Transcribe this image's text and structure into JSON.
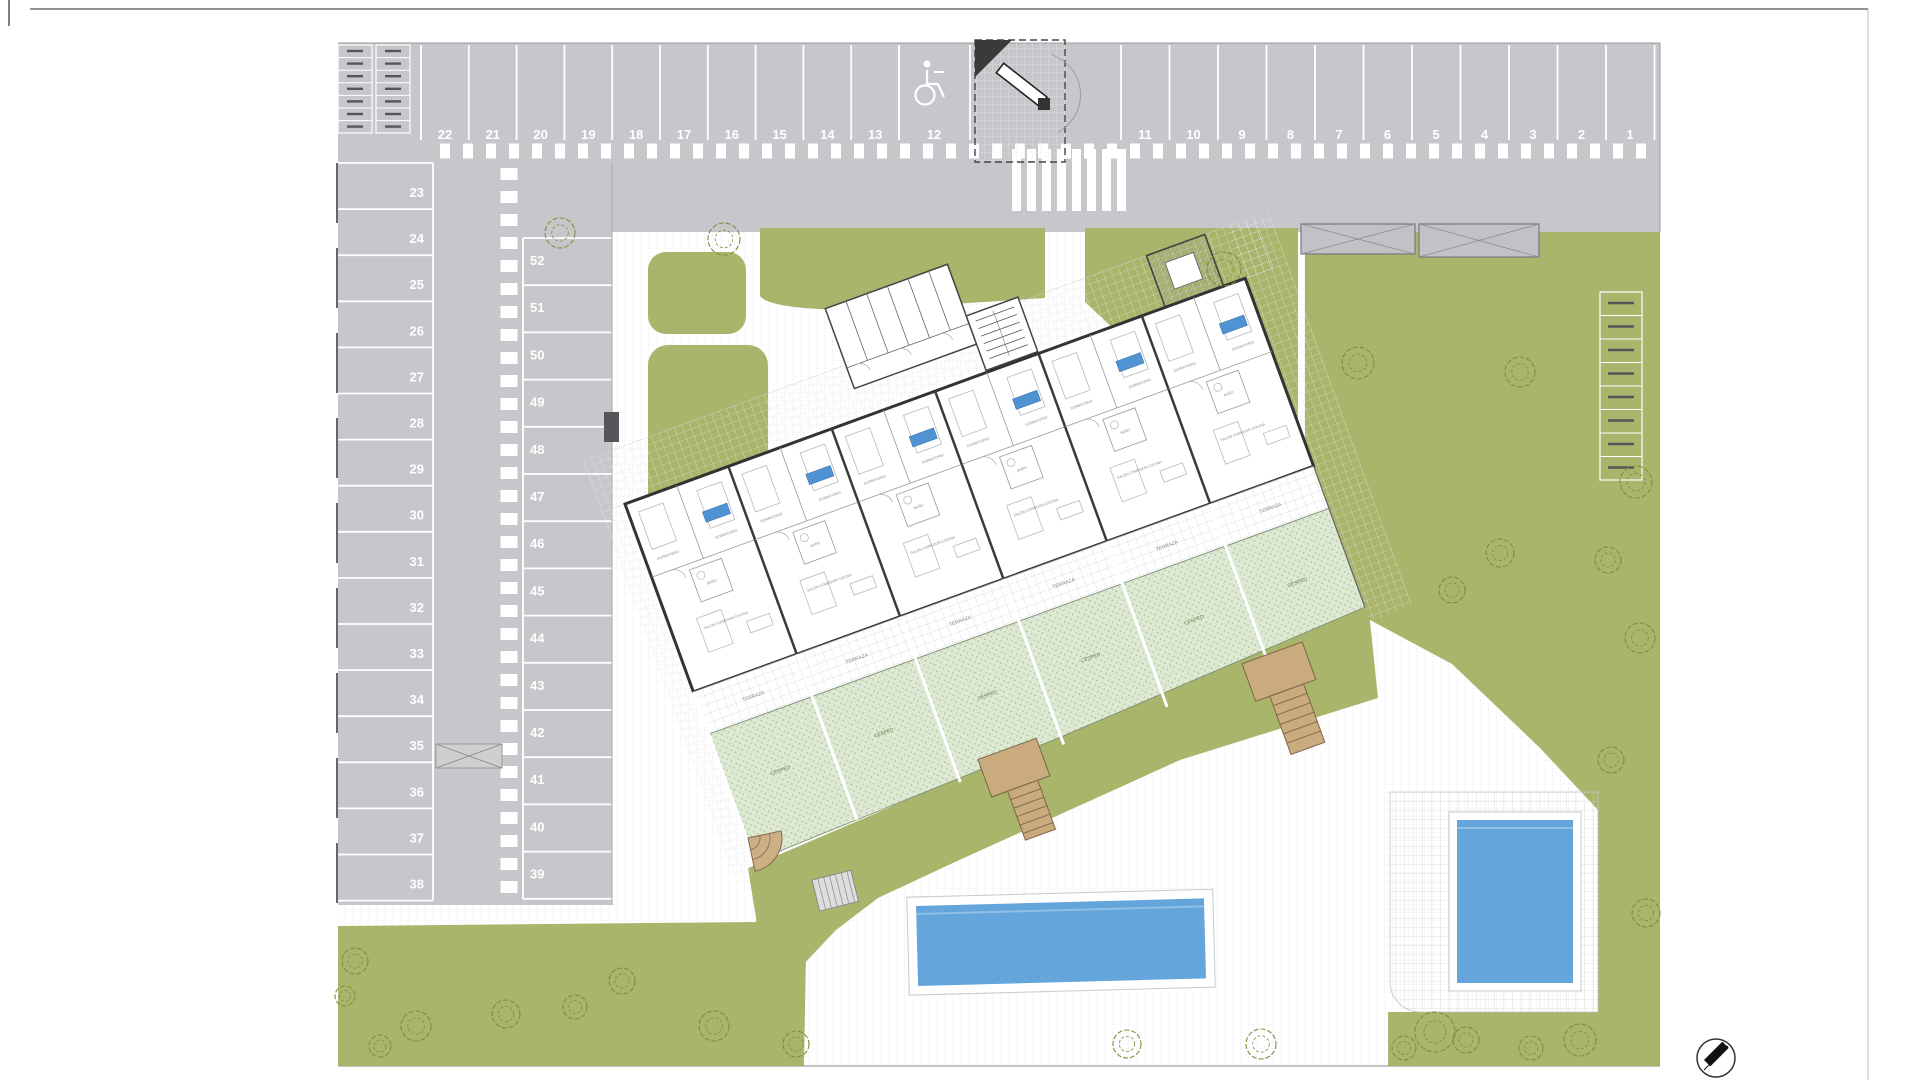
{
  "sheet": {
    "type": "architectural-site-plan",
    "compass": "north-arrow"
  },
  "parking": {
    "top_left_numbers": [
      "22",
      "21",
      "20",
      "19",
      "18",
      "17",
      "16",
      "15",
      "14",
      "13"
    ],
    "handicap_number": "12",
    "top_right_numbers": [
      "11",
      "10",
      "9",
      "8",
      "7",
      "6",
      "5",
      "4",
      "3",
      "2",
      "1"
    ],
    "left_column_numbers": [
      "23",
      "24",
      "25",
      "26",
      "27",
      "28",
      "29",
      "30",
      "31",
      "32",
      "33",
      "34",
      "35",
      "36",
      "37",
      "38"
    ],
    "middle_column_numbers": [
      "52",
      "51",
      "50",
      "49",
      "48",
      "47",
      "46",
      "45",
      "44",
      "43",
      "42",
      "41",
      "40",
      "39"
    ]
  },
  "building": {
    "unit_count": 6,
    "room_labels": {
      "bedroom": "DORMITORIO",
      "living": "SALÓN COMEDOR-COCINA",
      "bathroom": "BAÑO",
      "terrace": "TERRAZA",
      "lawn": "CÉSPED"
    }
  },
  "amenities": {
    "pool_count": 2
  },
  "icons": {
    "handicap": "wheelchair-icon",
    "compass": "north-arrow-icon",
    "bikes": "bicycle-rack-icon",
    "gate": "entrance-barrier-icon"
  },
  "colors": {
    "asphalt": "#c7c7cb",
    "communal_green": "#a9b56b",
    "private_lawn": "#dde9d2",
    "pool_water": "#64a5dc",
    "stairs_tan": "#c9ab7e",
    "unit_tag": "#4f93d2",
    "marking_white": "#ffffff",
    "tree_line": "#74923c"
  }
}
